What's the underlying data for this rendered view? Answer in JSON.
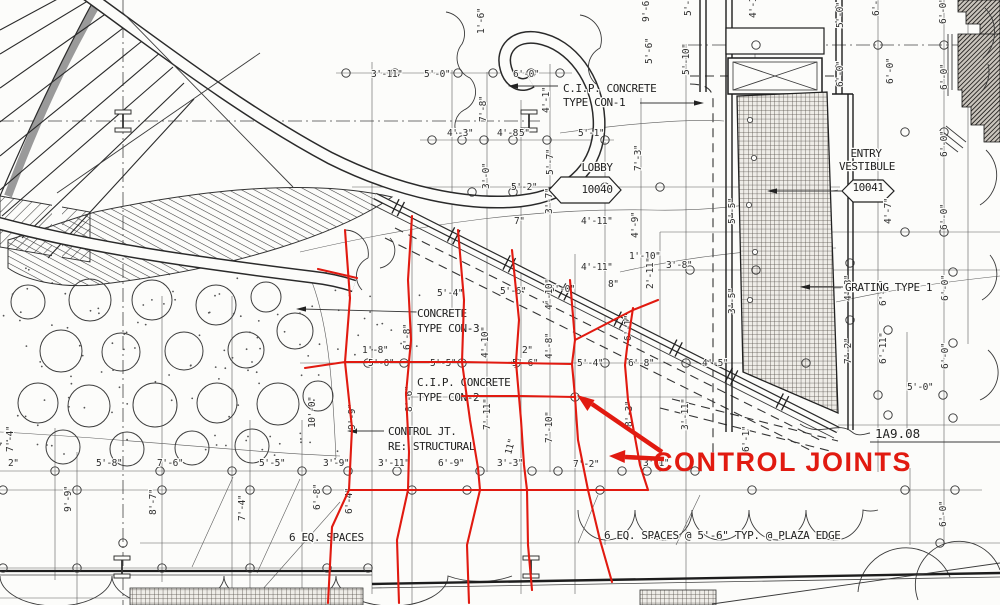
{
  "drawing": {
    "annotation": "CONTROL JOINTS",
    "colors": {
      "annotation_red": "#e11a10",
      "linework": "#2e2e2e",
      "paper": "#fcfcfa"
    },
    "rooms": [
      {
        "name": "LOBBY",
        "number": "10040"
      },
      {
        "name": "ENTRY VESTIBULE",
        "number": "10041"
      }
    ],
    "detail_reference": "1A9.08",
    "notes": [
      {
        "t": "C.I.P. CONCRETE",
        "x": 563,
        "y": 92,
        "cls": "note"
      },
      {
        "t": "TYPE CON-1",
        "x": 563,
        "y": 106,
        "cls": "note"
      },
      {
        "t": "LOBBY",
        "x": 597,
        "y": 171,
        "cls": "note",
        "mid": true
      },
      {
        "t": "10040",
        "x": 597,
        "y": 193,
        "cls": "note",
        "mid": true
      },
      {
        "t": "ENTRY",
        "x": 866,
        "y": 157,
        "cls": "note",
        "mid": true
      },
      {
        "t": "VESTIBULE",
        "x": 867,
        "y": 170,
        "cls": "note",
        "mid": true
      },
      {
        "t": "10041",
        "x": 868,
        "y": 191,
        "cls": "note",
        "mid": true
      },
      {
        "t": "GRATING TYPE 1",
        "x": 845,
        "y": 291,
        "cls": "note"
      },
      {
        "t": "CONCRETE",
        "x": 417,
        "y": 317,
        "cls": "note"
      },
      {
        "t": "TYPE CON-3",
        "x": 417,
        "y": 332,
        "cls": "note"
      },
      {
        "t": "C.I.P. CONCRETE",
        "x": 417,
        "y": 386,
        "cls": "note"
      },
      {
        "t": "TYPE CON-2",
        "x": 417,
        "y": 401,
        "cls": "note"
      },
      {
        "t": "CONTROL JT.",
        "x": 388,
        "y": 435,
        "cls": "note"
      },
      {
        "t": "RE: STRUCTURAL",
        "x": 388,
        "y": 450,
        "cls": "note"
      },
      {
        "t": "6 EQ. SPACES",
        "x": 289,
        "y": 541,
        "cls": "note"
      },
      {
        "t": "6 EQ. SPACES @ 5'-6\" TYP. @ PLAZA EDGE",
        "x": 604,
        "y": 539,
        "cls": "note"
      },
      {
        "t": "1A9.08",
        "x": 875,
        "y": 438,
        "cls": "ref"
      },
      {
        "t": "CONTROL JOINTS",
        "x": 653,
        "y": 471,
        "cls": "red-note"
      }
    ],
    "dimensions": [
      {
        "t": "3'-11\"",
        "x": 371,
        "y": 77
      },
      {
        "t": "5'-0\"",
        "x": 424,
        "y": 77
      },
      {
        "t": "6'-0\"",
        "x": 513,
        "y": 77
      },
      {
        "t": "1'-6\"",
        "x": 484,
        "y": 34,
        "r": -90
      },
      {
        "t": "7'-8\"",
        "x": 486,
        "y": 122,
        "r": -90
      },
      {
        "t": "4'-1\"",
        "x": 549,
        "y": 113,
        "r": -90
      },
      {
        "t": "4'-3\"",
        "x": 447,
        "y": 136
      },
      {
        "t": "4'-8\"",
        "x": 497,
        "y": 136
      },
      {
        "t": "5\"",
        "x": 519,
        "y": 136
      },
      {
        "t": "5'-1\"",
        "x": 578,
        "y": 136
      },
      {
        "t": "5'-7\"",
        "x": 553,
        "y": 175,
        "r": -90
      },
      {
        "t": "3'-0\"",
        "x": 489,
        "y": 189,
        "r": -90
      },
      {
        "t": "5'-2\"",
        "x": 511,
        "y": 190
      },
      {
        "t": "7'-3\"",
        "x": 641,
        "y": 171,
        "r": -90
      },
      {
        "t": "9'-6\"",
        "x": 649,
        "y": 22,
        "r": -90
      },
      {
        "t": "5'-6\"",
        "x": 652,
        "y": 64,
        "r": -90
      },
      {
        "t": "5'-3\"",
        "x": 691,
        "y": 16,
        "r": -90
      },
      {
        "t": "5'-10\"",
        "x": 689,
        "y": 75,
        "r": -90
      },
      {
        "t": "4'-11\"",
        "x": 756,
        "y": 18,
        "r": -90
      },
      {
        "t": "5'-0\"",
        "x": 843,
        "y": 28,
        "r": -90
      },
      {
        "t": "6'-0\"",
        "x": 879,
        "y": 16,
        "r": -90
      },
      {
        "t": "6'-0\"",
        "x": 946,
        "y": 24,
        "r": -90
      },
      {
        "t": "6'-0\"",
        "x": 843,
        "y": 87,
        "r": -90
      },
      {
        "t": "6'-0\"",
        "x": 893,
        "y": 84,
        "r": -90
      },
      {
        "t": "6'-0\"",
        "x": 947,
        "y": 90,
        "r": -90
      },
      {
        "t": "6'-0\"",
        "x": 947,
        "y": 157,
        "r": -90
      },
      {
        "t": "4'-7\"",
        "x": 891,
        "y": 224,
        "r": -90
      },
      {
        "t": "6'-0\"",
        "x": 947,
        "y": 230,
        "r": -90
      },
      {
        "t": "7\"",
        "x": 514,
        "y": 224
      },
      {
        "t": "3'-7\"",
        "x": 552,
        "y": 214,
        "r": -90
      },
      {
        "t": "4'-11\"",
        "x": 581,
        "y": 224
      },
      {
        "t": "4'-9\"",
        "x": 638,
        "y": 238,
        "r": -90
      },
      {
        "t": "1'-10\"",
        "x": 629,
        "y": 259
      },
      {
        "t": "4'-11\"",
        "x": 581,
        "y": 270
      },
      {
        "t": "3'-8\"",
        "x": 666,
        "y": 268
      },
      {
        "t": "2'-11\"",
        "x": 653,
        "y": 289,
        "r": -90
      },
      {
        "t": "8\"",
        "x": 608,
        "y": 287
      },
      {
        "t": "5'-4\"",
        "x": 437,
        "y": 296
      },
      {
        "t": "5'-6\"",
        "x": 500,
        "y": 294
      },
      {
        "t": "5'-0\"",
        "x": 549,
        "y": 292
      },
      {
        "t": "4'-10\"",
        "x": 552,
        "y": 310,
        "r": -90
      },
      {
        "t": "5'-5\"",
        "x": 735,
        "y": 224,
        "r": -90
      },
      {
        "t": "3'-5\"",
        "x": 735,
        "y": 314,
        "r": -90
      },
      {
        "t": "1'-8\"",
        "x": 362,
        "y": 353
      },
      {
        "t": "5'-0\"",
        "x": 368,
        "y": 366
      },
      {
        "t": "6'-8\"",
        "x": 410,
        "y": 350,
        "r": -90
      },
      {
        "t": "5'-5\"",
        "x": 430,
        "y": 366
      },
      {
        "t": "4'-10\"",
        "x": 488,
        "y": 358,
        "r": -90
      },
      {
        "t": "2\"",
        "x": 522,
        "y": 353
      },
      {
        "t": "5'-6\"",
        "x": 512,
        "y": 366
      },
      {
        "t": "4'-8\"",
        "x": 552,
        "y": 359,
        "r": -90
      },
      {
        "t": "5'-4\"",
        "x": 577,
        "y": 366
      },
      {
        "t": "6'-8\"",
        "x": 628,
        "y": 366
      },
      {
        "t": "4'-5\"",
        "x": 702,
        "y": 366
      },
      {
        "t": "8'-6\"",
        "x": 412,
        "y": 412,
        "r": -90
      },
      {
        "t": "9'-9\"",
        "x": 355,
        "y": 430,
        "r": -90
      },
      {
        "t": "6'-4\"",
        "x": 352,
        "y": 514,
        "r": -90
      },
      {
        "t": "6'-1\"",
        "x": 631,
        "y": 341,
        "r": -90
      },
      {
        "t": "4'-8\"",
        "x": 851,
        "y": 301,
        "r": -90
      },
      {
        "t": "6'-1\"",
        "x": 886,
        "y": 306,
        "r": -90
      },
      {
        "t": "6'-0\"",
        "x": 948,
        "y": 301,
        "r": -90
      },
      {
        "t": "7'-2\"",
        "x": 851,
        "y": 364,
        "r": -90
      },
      {
        "t": "6'-11\"",
        "x": 886,
        "y": 364,
        "r": -90
      },
      {
        "t": "5'-0\"",
        "x": 907,
        "y": 390
      },
      {
        "t": "6'-0\"",
        "x": 948,
        "y": 369,
        "r": -90
      },
      {
        "t": "2\"",
        "x": 8,
        "y": 466
      },
      {
        "t": "5'-8\"",
        "x": 96,
        "y": 466
      },
      {
        "t": "7'-6\"",
        "x": 157,
        "y": 466
      },
      {
        "t": "5'-5\"",
        "x": 259,
        "y": 466
      },
      {
        "t": "3'-9\"",
        "x": 323,
        "y": 466
      },
      {
        "t": "3'-11\"",
        "x": 378,
        "y": 466
      },
      {
        "t": "6'-9\"",
        "x": 438,
        "y": 466
      },
      {
        "t": "3'-3\"",
        "x": 497,
        "y": 466
      },
      {
        "t": "7'-2\"",
        "x": 573,
        "y": 467
      },
      {
        "t": "3'-1\"",
        "x": 643,
        "y": 466
      },
      {
        "t": "7'-4\"",
        "x": 13,
        "y": 452,
        "r": -90
      },
      {
        "t": "10'-0\"",
        "x": 315,
        "y": 428,
        "r": -90
      },
      {
        "t": "7'-11\"",
        "x": 490,
        "y": 430,
        "r": -90
      },
      {
        "t": "11\"",
        "x": 511,
        "y": 455,
        "r": -75
      },
      {
        "t": "7'-10\"",
        "x": 552,
        "y": 443,
        "r": -90
      },
      {
        "t": "8'-3\"",
        "x": 632,
        "y": 427,
        "r": -90
      },
      {
        "t": "3'-11\"",
        "x": 688,
        "y": 430,
        "r": -90
      },
      {
        "t": "6'-1\"",
        "x": 749,
        "y": 452,
        "r": -90
      },
      {
        "t": "9'-9\"",
        "x": 71,
        "y": 512,
        "r": -90
      },
      {
        "t": "8'-7\"",
        "x": 156,
        "y": 515,
        "r": -90
      },
      {
        "t": "7'-4\"",
        "x": 245,
        "y": 521,
        "r": -90
      },
      {
        "t": "6'-8\"",
        "x": 320,
        "y": 510,
        "r": -90
      },
      {
        "t": "6'-0\"",
        "x": 946,
        "y": 527,
        "r": -90
      }
    ]
  }
}
